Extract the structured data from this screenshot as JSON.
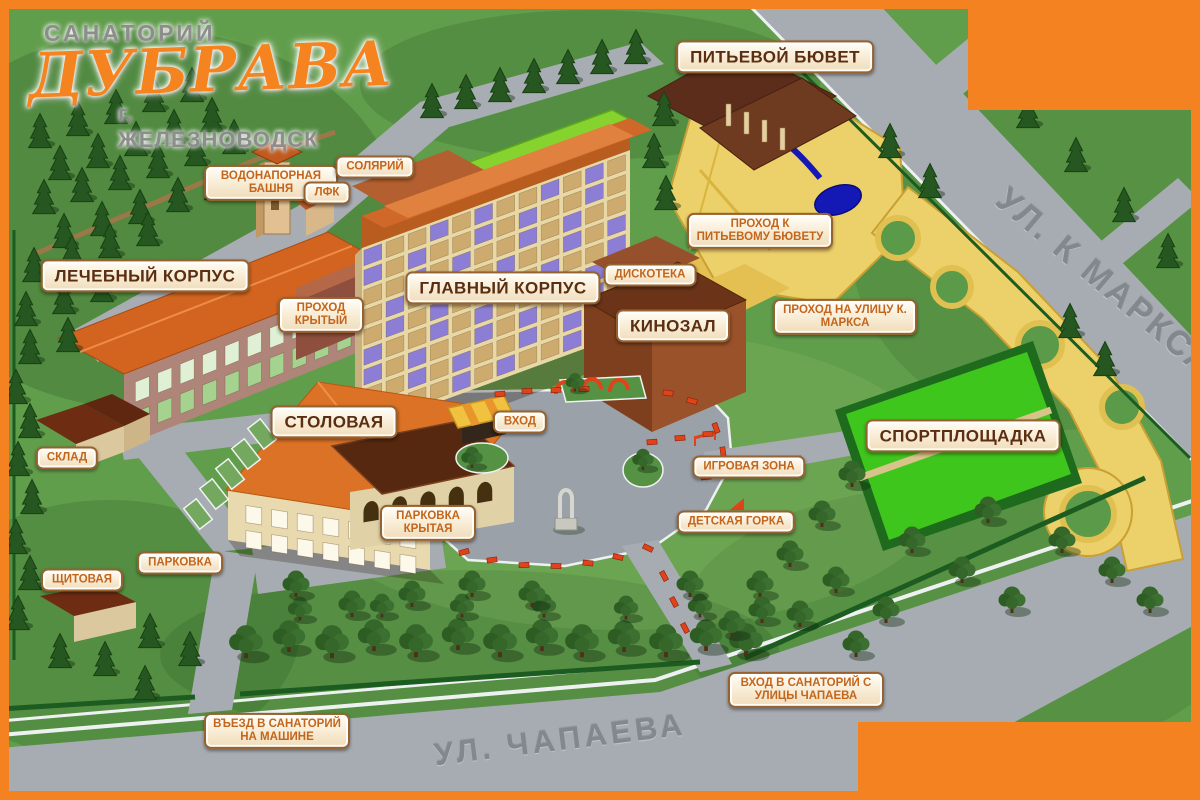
{
  "logo": {
    "top": "САНАТОРИЙ",
    "name": "ДУБРАВА",
    "city": "г. ЖЕЛЕЗНОВОДСК"
  },
  "streets": {
    "marksa": "УЛ. К МАРКСА",
    "chapaeva": "УЛ. ЧАПАЕВА"
  },
  "labels": {
    "pitevoy_byuvet": "ПИТЬЕВОЙ БЮВЕТ",
    "vodonapornaya_bashnya": "ВОДОНАПОРНАЯ БАШНЯ",
    "solyariy": "СОЛЯРИЙ",
    "lfk": "ЛФК",
    "lechebny_korpus": "ЛЕЧЕБНЫЙ КОРПУС",
    "prohod_kryty": "ПРОХОД КРЫТЫЙ",
    "glavny_korpus": "ГЛАВНЫЙ КОРПУС",
    "diskoteka": "ДИСКОТЕКА",
    "kinozal": "КИНОЗАЛ",
    "prohod_k_byuvetu": "ПРОХОД К ПИТЬЕВОМУ БЮВЕТУ",
    "prohod_na_marksa": "ПРОХОД НА УЛИЦУ К. МАРКСА",
    "stolovaya": "СТОЛОВАЯ",
    "vhod": "ВХОД",
    "sklad": "СКЛАД",
    "igrovaya_zona": "ИГРОВАЯ ЗОНА",
    "sportploshchadka": "СПОРТПЛОЩАДКА",
    "detskaya_gorka": "ДЕТСКАЯ ГОРКА",
    "parkovka_krytaya": "ПАРКОВКА КРЫТАЯ",
    "parkovka": "ПАРКОВКА",
    "shchitovaya": "ЩИТОВАЯ",
    "vyezd": "ВЪЕЗД В САНАТОРИЙ НА МАШИНЕ",
    "vhod_s_chapaeva": "ВХОД В САНАТОРИЙ С УЛИЦЫ ЧАПАЕВА"
  },
  "colors": {
    "frame_orange": "#f58220",
    "label_major_text": "#5b2e12",
    "label_minor_text": "#c4651c",
    "grass": "#619e4c",
    "road_gray": "#a7acb2",
    "walkway_yellow": "#ecd06a",
    "water_blue": "#1418b4",
    "sport_field_green": "#3fc61c",
    "roof_orange": "#d2641f",
    "bench_red": "#e0431a"
  }
}
